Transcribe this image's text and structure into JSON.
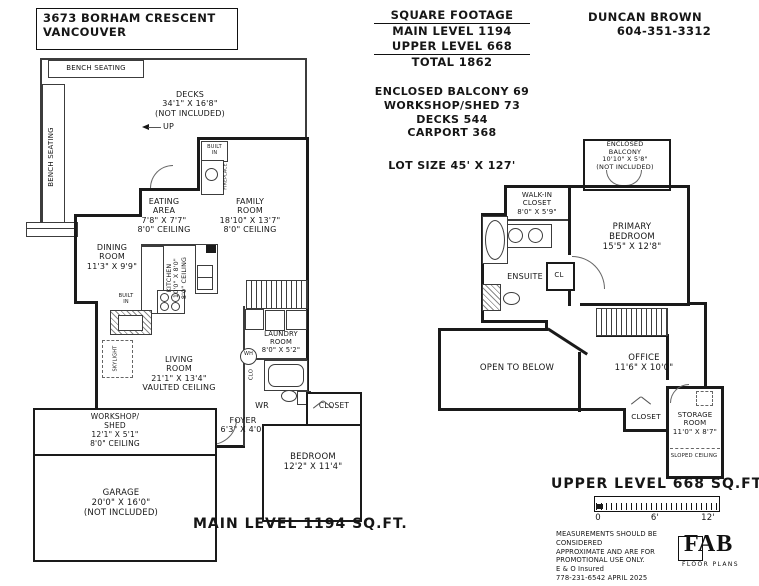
{
  "title_block": {
    "address_line1": "3673 BORHAM CRESCENT",
    "address_line2": "VANCOUVER"
  },
  "square_footage": {
    "title": "SQUARE FOOTAGE",
    "main_level": "MAIN LEVEL 1194",
    "upper_level": "UPPER LEVEL 668",
    "total": "TOTAL 1862",
    "extras": [
      "ENCLOSED BALCONY 69",
      "WORKSHOP/SHED 73",
      "DECKS 544",
      "CARPORT 368"
    ],
    "lot_size": "LOT SIZE 45' X 127'"
  },
  "contact": {
    "name": "DUNCAN BROWN",
    "phone": "604-351-3312"
  },
  "main_level": {
    "label": "MAIN LEVEL 1194 SQ.FT.",
    "bench_seating_top": "BENCH SEATING",
    "bench_seating_left": "BENCH SEATING",
    "decks": [
      "DECKS",
      "34'1\" X 16'8\"",
      "(NOT INCLUDED)"
    ],
    "up": "UP",
    "built_in_fireplace": [
      "BUILT",
      "IN"
    ],
    "fireplace": "FIREPLACE",
    "eating_area": [
      "EATING",
      "AREA",
      "7'8\" X 7'7\"",
      "8'0\" CEILING"
    ],
    "family_room": [
      "FAMILY",
      "ROOM",
      "18'10\" X 13'7\"",
      "8'0\" CEILING"
    ],
    "dining_room": [
      "DINING",
      "ROOM",
      "11'3\" X 9'9\""
    ],
    "kitchen": [
      "KITCHEN",
      "10'0\" X 8'0\"",
      "8'0\" CEILING"
    ],
    "built_in_dining": [
      "BUILT",
      "IN"
    ],
    "skylight": "SKYLIGHT",
    "living_room": [
      "LIVING",
      "ROOM",
      "21'1\" X 13'4\"",
      "VAULTED CEILING"
    ],
    "laundry_room": [
      "LAUNDRY",
      "ROOM",
      "8'0\" X 5'2\""
    ],
    "water_heater": "WH",
    "closet_small": "CLO",
    "washroom": "WR",
    "foyer": [
      "FOYER",
      "6'3\" X 4'0\""
    ],
    "closet": "CLOSET",
    "bedroom": [
      "BEDROOM",
      "12'2\" X 11'4\""
    ],
    "workshop": [
      "WORKSHOP/",
      "SHED",
      "12'1\" X 5'1\"",
      "8'0\" CEILING"
    ],
    "garage": [
      "GARAGE",
      "20'0\" X 16'0\"",
      "(NOT INCLUDED)"
    ]
  },
  "upper_level": {
    "label": "UPPER LEVEL 668 SQ.FT.",
    "enclosed_balcony": [
      "ENCLOSED",
      "BALCONY",
      "10'10\" X 5'8\"",
      "(NOT INCLUDED)"
    ],
    "walk_in_closet": [
      "WALK-IN",
      "CLOSET",
      "8'0\" X 5'9\""
    ],
    "primary_bedroom": [
      "PRIMARY",
      "BEDROOM",
      "15'5\" X 12'8\""
    ],
    "ensuite": "ENSUITE",
    "closet_cl": "CL",
    "open_to_below": "OPEN TO BELOW",
    "office": [
      "OFFICE",
      "11'6\" X 10'0\""
    ],
    "closet": "CLOSET",
    "storage_room": [
      "STORAGE",
      "ROOM",
      "11'0\" X 8'7\""
    ],
    "sloped_ceiling": "SLOPED CEILING"
  },
  "scale_bar": {
    "t0": "0",
    "t6": "6'",
    "t12": "12'"
  },
  "footer": {
    "disclaimer": [
      "MEASUREMENTS SHOULD BE CONSIDERED",
      "APPROXIMATE AND ARE FOR",
      "PROMOTIONAL USE ONLY.",
      "E & O Insured",
      "778-231-6542  APRIL 2025"
    ],
    "logo_name": "FAB",
    "logo_tagline": "FLOOR PLANS"
  }
}
